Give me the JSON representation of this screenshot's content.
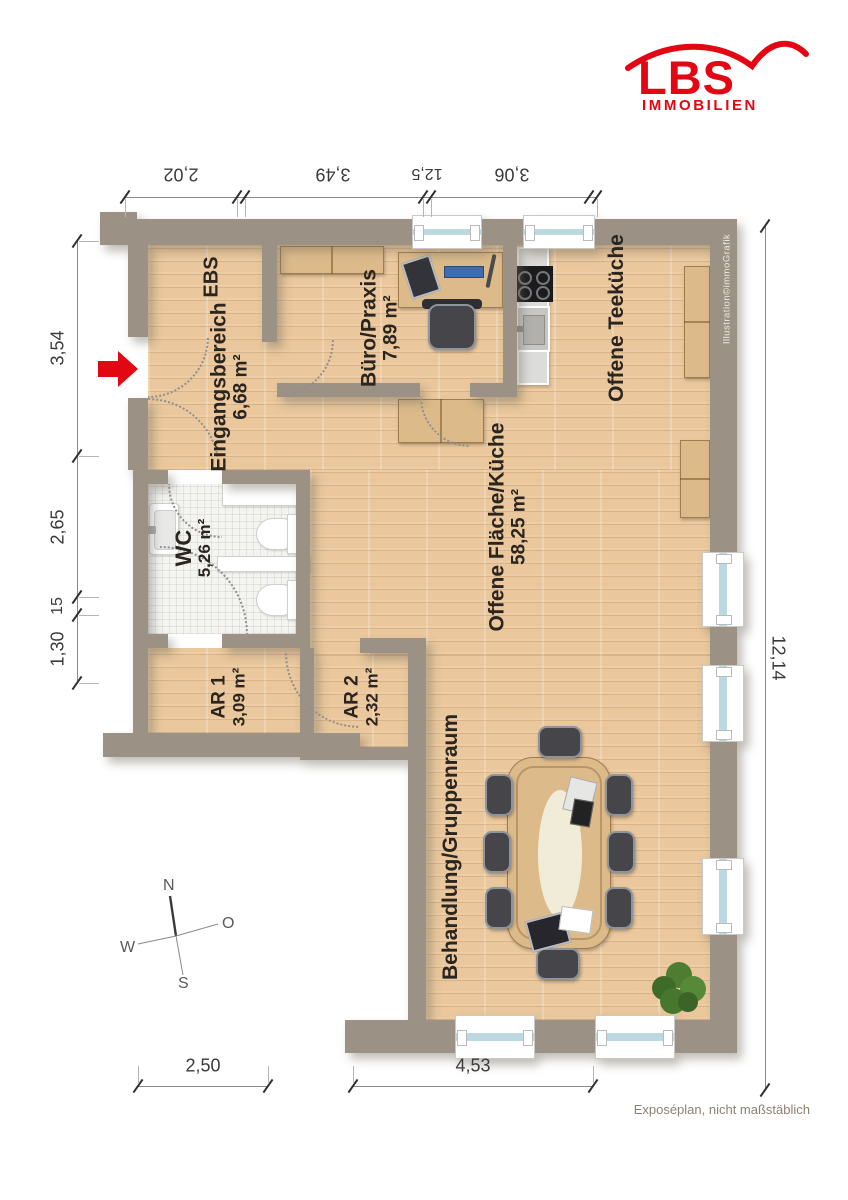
{
  "brand": {
    "name": "LBS",
    "subtitle": "IMMOBILIEN"
  },
  "rooms": {
    "ebs": {
      "name": "EBS"
    },
    "eingang": {
      "name": "Eingangsbereich",
      "area": "6,68 m²"
    },
    "buero": {
      "name": "Büro/Praxis",
      "area": "7,89 m²"
    },
    "teekueche": {
      "name": "Offene Teeküche"
    },
    "flaeche": {
      "name": "Offene Fläche/Küche",
      "area": "58,25 m²"
    },
    "wc": {
      "name": "WC",
      "area": "5,26 m²"
    },
    "ar1": {
      "name": "AR 1",
      "area": "3,09 m²"
    },
    "ar2": {
      "name": "AR 2",
      "area": "2,32 m²"
    },
    "behandlung": {
      "name": "Behandlung/Gruppenraum"
    }
  },
  "dimensions": {
    "top": [
      "2,02",
      "3,49",
      "12,5",
      "3,06"
    ],
    "left": [
      "3,54",
      "2,65",
      "15",
      "1,30"
    ],
    "right": [
      "12,14"
    ],
    "bottom": [
      "2,50",
      "4,53"
    ]
  },
  "compass": {
    "north": "N",
    "east": "O",
    "south": "S",
    "west": "W"
  },
  "credit": {
    "text": "Illustration©immoGrafik"
  },
  "footer": {
    "note": "Exposéplan, nicht maßstäblich"
  },
  "colors": {
    "brand_red": "#e30613",
    "wall": "#9b9285",
    "wood_floor": "#eac79c",
    "tile_floor": "#f4f4f1",
    "glass_blue": "#bcd9e2",
    "chair_dark": "#45454a",
    "plant_green": "#4e7d32"
  }
}
